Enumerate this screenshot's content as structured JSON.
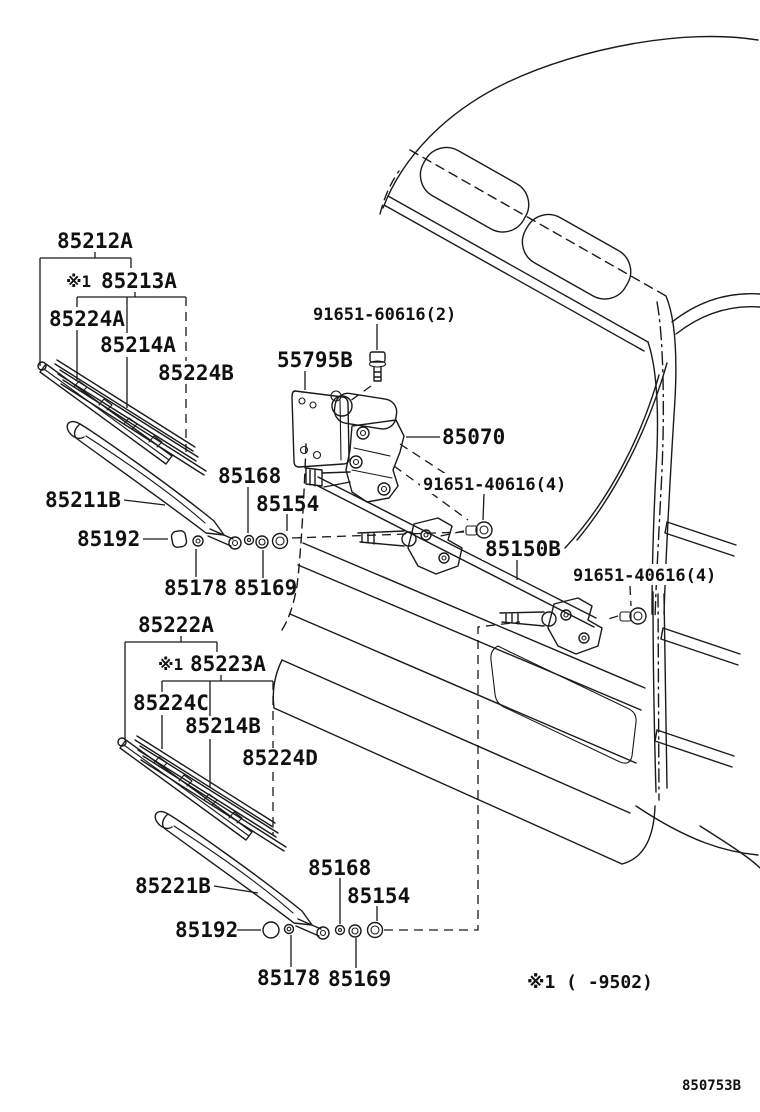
{
  "diagram": {
    "title_code": "850753B",
    "footnote": "※1 (    -9502)",
    "upper_blade": {
      "assy": "85212A",
      "note": "※1",
      "sub_assy": "85213A",
      "backing_1": "85224A",
      "rubber": "85214A",
      "backing_2": "85224B"
    },
    "upper_arm": {
      "arm": "85211B",
      "cap": "85192",
      "washer": "85178",
      "piece": "85168",
      "spacer": "85169",
      "grommet": "85154"
    },
    "motor_group": {
      "bracket": "55795B",
      "motor_screws": "91651-60616(2)",
      "motor": "85070",
      "pivot_bolt_1": "91651-40616(4)",
      "link": "85150B",
      "pivot_bolt_2": "91651-40616(4)"
    },
    "lower_blade": {
      "assy": "85222A",
      "note": "※1",
      "sub_assy": "85223A",
      "backing_1": "85224C",
      "rubber": "85214B",
      "backing_2": "85224D"
    },
    "lower_arm": {
      "arm": "85221B",
      "cap": "85192",
      "washer": "85178",
      "piece": "85168",
      "spacer": "85169",
      "grommet": "85154"
    }
  }
}
